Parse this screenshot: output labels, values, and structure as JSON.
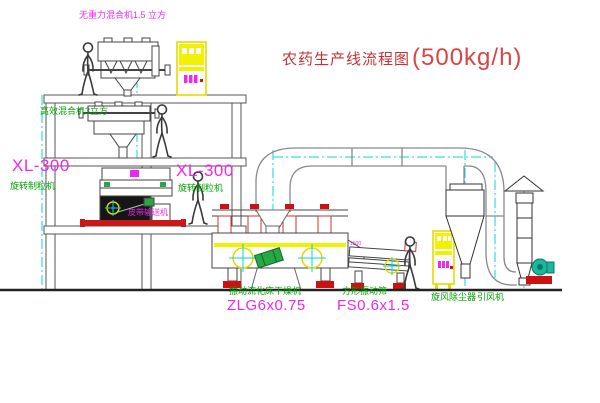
{
  "title": {
    "prefix": "农药生产线流程图",
    "capacity": "(500kg/h)"
  },
  "labels": {
    "mixer_top": "无重力混合机1.5 立方",
    "mixer_mid": "高效混合机3立方",
    "granulator_left_model": "XL-300",
    "granulator_left_name": "旋转制粒机",
    "granulator_right_model": "XL-300",
    "granulator_right_name": "旋转制粒机",
    "belt_conveyor": "皮带输送机",
    "dryer_name": "振动流化床干燥机",
    "dryer_model": "ZLG6x0.75",
    "sieve_name": "方形振动筛",
    "sieve_model": "FS0.6x1.5",
    "cyclone_name": "旋风除尘器",
    "fan_name": "引风机",
    "dim_note": "1500"
  },
  "colors": {
    "label_magenta": "#ee28ee",
    "label_green": "#00a400",
    "title_red": "#c63232",
    "accent_red": "#cc1111",
    "equipment_yellow": "#f2f200",
    "centerline_cyan": "#00d8d8",
    "motor_green": "#28a845"
  }
}
